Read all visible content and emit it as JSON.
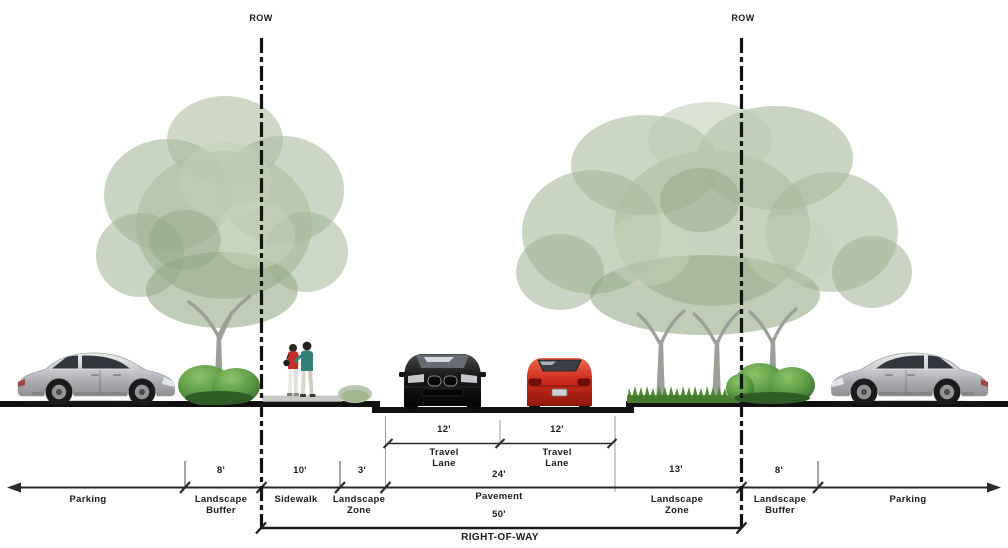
{
  "meta": {
    "title": "Street cross-section right-of-way diagram"
  },
  "row_markers": {
    "left": "ROW",
    "right": "ROW"
  },
  "travel_lanes": {
    "left": {
      "width": "12'",
      "name": "Travel\nLane"
    },
    "right": {
      "width": "12'",
      "name": "Travel\nLane"
    }
  },
  "pavement": {
    "width": "24'",
    "label": "Pavement"
  },
  "right_of_way": {
    "width": "50'",
    "label": "RIGHT-OF-WAY"
  },
  "zones": {
    "parking_left": {
      "label": "Parking"
    },
    "landscape_buffer_left": {
      "width": "8'",
      "label": "Landscape\nBuffer"
    },
    "sidewalk": {
      "width": "10'",
      "label": "Sidewalk"
    },
    "landscape_zone_left": {
      "width": "3'",
      "label": "Landscape\nZone"
    },
    "landscape_zone_right": {
      "width": "13'",
      "label": "Landscape\nZone"
    },
    "landscape_buffer_right": {
      "width": "8'",
      "label": "Landscape\nBuffer"
    },
    "parking_right": {
      "label": "Parking"
    }
  },
  "scene": {
    "vehicles": [
      {
        "id": "silver-sedan-parked-left",
        "color": "#bfc0c4"
      },
      {
        "id": "black-car-travel-lane",
        "color": "#161616"
      },
      {
        "id": "red-car-travel-lane",
        "color": "#c8271c"
      },
      {
        "id": "silver-sedan-parked-right",
        "color": "#bfc0c4"
      }
    ],
    "pedestrians": {
      "id": "walking-couple"
    },
    "vegetation": [
      {
        "id": "street-tree-left"
      },
      {
        "id": "street-tree-cluster-right"
      },
      {
        "id": "shrub-landscape-buffer-left"
      },
      {
        "id": "shrub-landscape-zone-left"
      },
      {
        "id": "grass-landscape-zone-right"
      },
      {
        "id": "shrub-landscape-buffer-right"
      }
    ],
    "foliage_color": "#aabfa0",
    "grass_color": "#4e8a33",
    "ground_color": "#111111",
    "dimension_color": "#2a2a2a"
  }
}
